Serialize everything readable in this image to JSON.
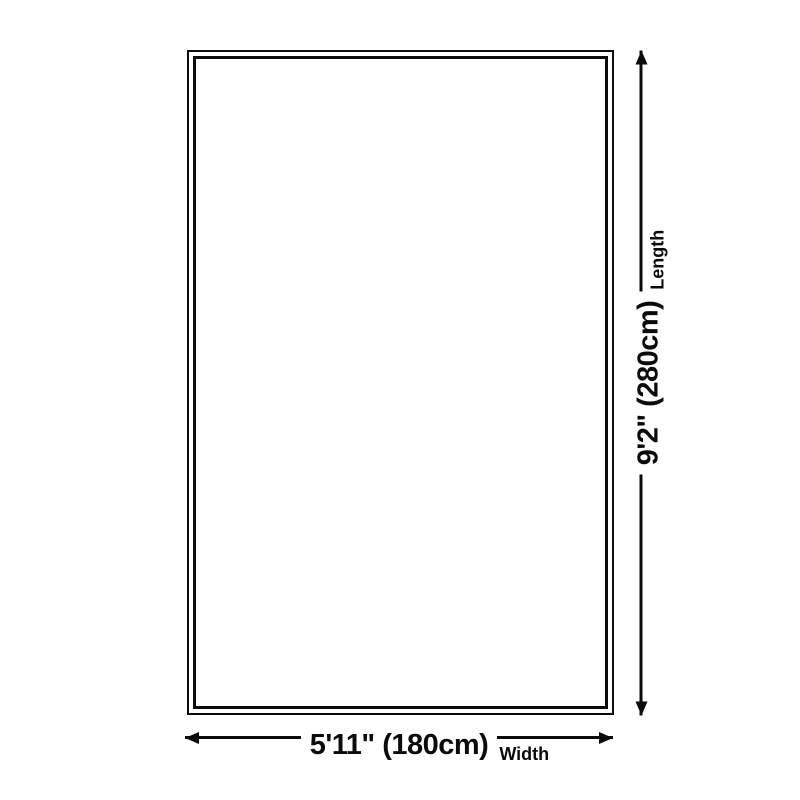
{
  "diagram": {
    "type": "product-size-diagram",
    "background_color": "#ffffff",
    "line_color": "#0b0b0b",
    "shape": "rectangle-double-outline",
    "dimensions": {
      "length": {
        "value": "9'2\" (280cm)",
        "label": "Length"
      },
      "width": {
        "value": "5'11\" (180cm)",
        "label": "Width"
      }
    }
  }
}
